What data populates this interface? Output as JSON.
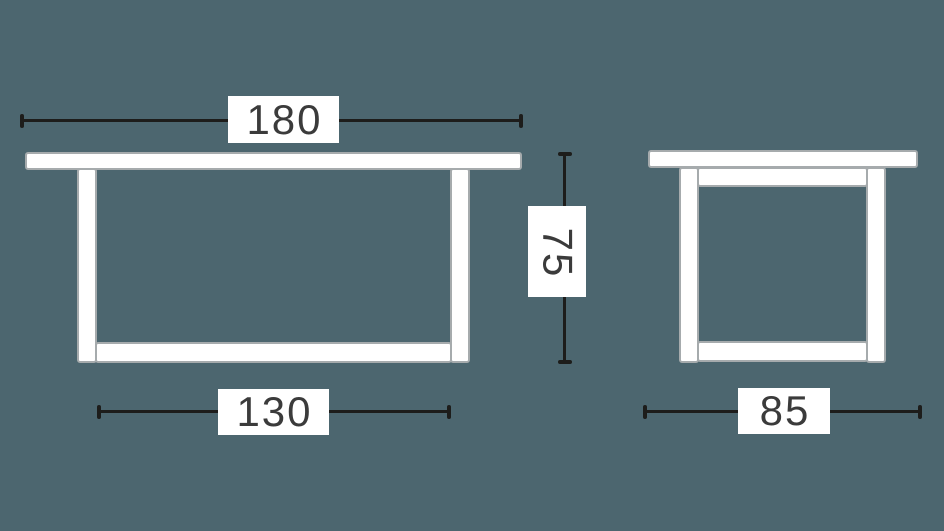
{
  "diagram": {
    "subject": "table-dimension-drawing",
    "dimensions": {
      "front": {
        "width": "180",
        "height": "75",
        "base_width": "130"
      },
      "side": {
        "depth": "85"
      }
    },
    "colors": {
      "background": "#4C666F",
      "shape_fill": "#FFFFFF",
      "shape_outline": "#A6ABAD",
      "dimension_line": "#1D1D1B",
      "label_background": "#FFFFFF",
      "label_text": "#3B3B3B"
    }
  }
}
